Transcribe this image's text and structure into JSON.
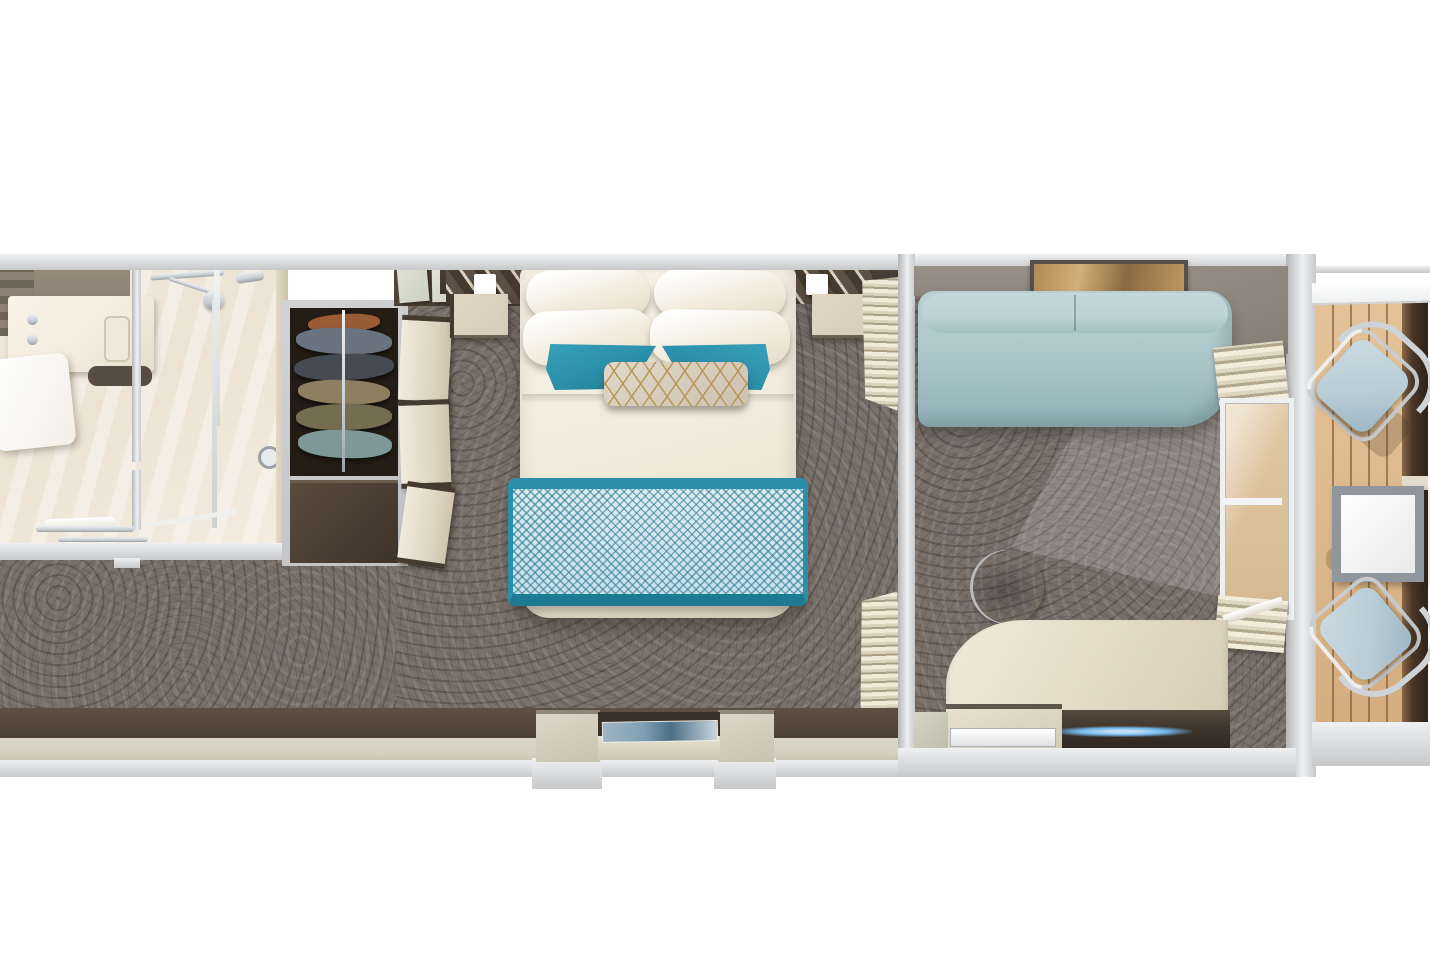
{
  "scene": {
    "description": "Top-down 3D rendering of a cruise ship balcony stateroom floor plan",
    "view": "birds-eye plan render",
    "background": "#ffffff"
  },
  "rooms": [
    {
      "id": "bathroom",
      "name": "Bathroom",
      "features": [
        "vanity-counter",
        "sink-faucet",
        "toilet",
        "walk-in-shower",
        "glass-door",
        "towel-rail"
      ]
    },
    {
      "id": "wardrobe",
      "name": "Wardrobe",
      "features": [
        "hanging-clothes-rail",
        "open-closet-doors",
        "storage-cabinet",
        "overhead-cabinet"
      ]
    },
    {
      "id": "corridor",
      "name": "Entry Corridor",
      "features": [
        "carpet"
      ]
    },
    {
      "id": "bedroom",
      "name": "Bedroom",
      "features": [
        "double-bed",
        "white-pillows",
        "teal-accent-pillows",
        "gold-pattern-bolster",
        "teal-diamond-bed-runner",
        "headboard",
        "two-nightstands",
        "two-wall-lamps",
        "art-niche-console"
      ]
    },
    {
      "id": "sitting-area",
      "name": "Sitting Area",
      "features": [
        "sofa",
        "wall-art",
        "curved-desk",
        "round-stool",
        "shelf-with-tray",
        "led-strip",
        "roman-curtains",
        "sliding-glass-door"
      ]
    },
    {
      "id": "balcony",
      "name": "Balcony",
      "features": [
        "teak-decking",
        "two-sling-chairs",
        "square-side-table",
        "privacy-partition",
        "railing"
      ]
    }
  ],
  "colors": {
    "white": "#ffffff",
    "wallLight": "#eef0f1",
    "wallMid": "#c6c8ca",
    "innerWall": "#8b8580",
    "carpet": "#7a716a",
    "bandBrown": "#54463a",
    "bandBeige": "#d5d1c0",
    "cream": "#f2ecdd",
    "creamDark": "#d8cdba",
    "darkBrown": "#453a2f",
    "closetDark": "#241d16",
    "teal": "#2b8fa9",
    "tealDeep": "#1d7a93",
    "runnerLight": "#c8e0ea",
    "sofa": "#a9c4c8",
    "sofaLight": "#bdd3d5",
    "wood": "#ddb88c",
    "rail": "#4a3627",
    "chairBlue": "#b9cdd7",
    "metal": "#c9ced3",
    "gold": "#b4924e",
    "artTan": "#c09a62",
    "artBlue": "#7fa0b5",
    "led": "#6fb4e8",
    "marble": "#ece3d3",
    "taupe": "#8c8172",
    "sage": "#cdd1c2"
  }
}
